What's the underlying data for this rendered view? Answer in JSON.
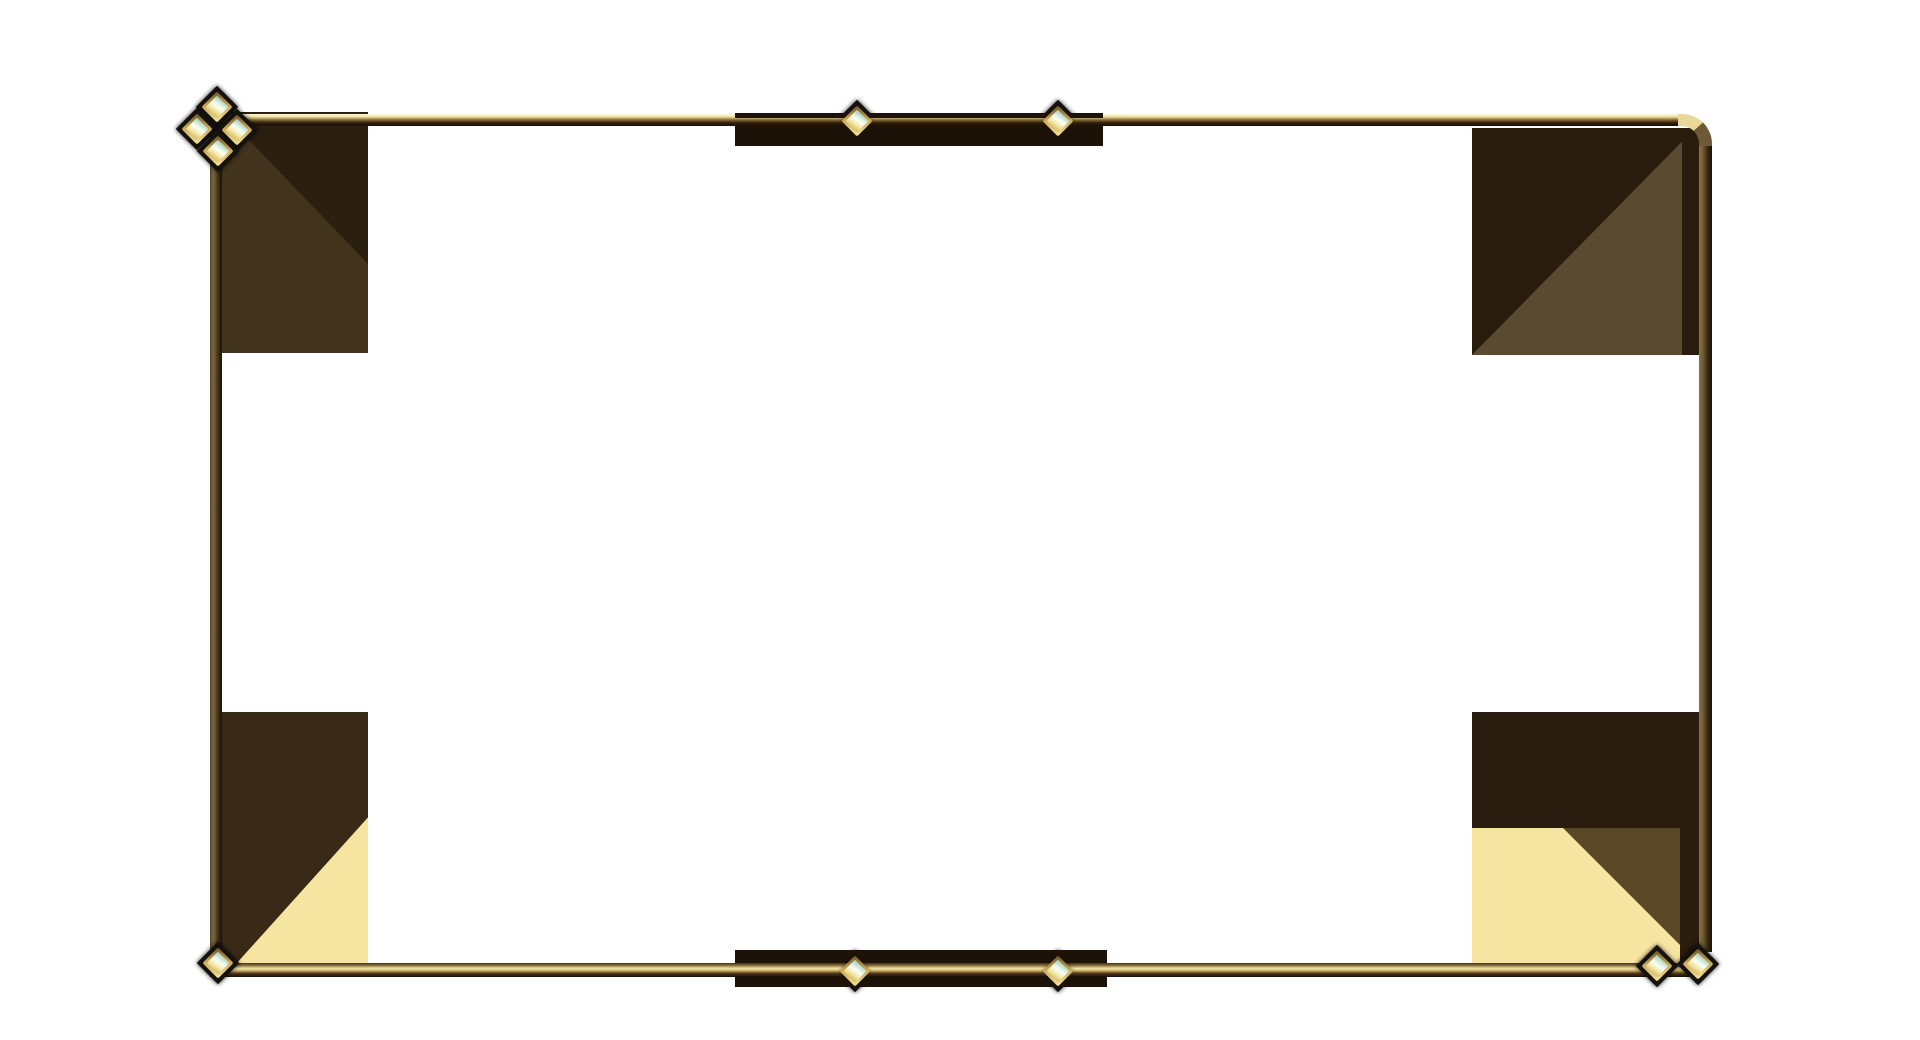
{
  "scene": {
    "description": "Ornate golden rectangular frame overlay on a white background, with dark brown corner blocks shaded by diagonal triangles, cream accents in the lower corners, dark accent bars on the top and bottom edges, and jeweled diamond gems: a four-gem cluster at the top-left corner, two gems on the top edge, two gems on the bottom edge, one gem at the bottom-left corner and a pair of gems at the bottom-right corner. The top-right corner of the frame is rounded.",
    "visible_text": ""
  },
  "colors": {
    "background": "#ffffff",
    "line-pale": "#fdf8da",
    "line-bright": "#f3e5ab",
    "line-gold": "#b89a58",
    "line-dark": "#1a1005",
    "bar": "#1c1208",
    "pad": "#151210",
    "block-tl": "#42331c",
    "block-tl-dark": "#2b1f10",
    "block-tr-dark": "#2a1c0c",
    "block-tr-light": "#594b30",
    "block-bl": "#392a17",
    "cream": "#f6e5a1",
    "block-br-dark": "#2a1c0e",
    "block-br-brown": "#594728",
    "gem-rim": "#c9a855",
    "gem-aqua": "#dff2e6",
    "gem-yellow": "#f3eaae"
  },
  "gems": [
    {
      "name": "corner-cluster-gem-top",
      "x": 217,
      "y": 107,
      "pad": "front"
    },
    {
      "name": "corner-cluster-gem-left",
      "x": 197,
      "y": 129,
      "pad": "front"
    },
    {
      "name": "corner-cluster-gem-right",
      "x": 237,
      "y": 130,
      "pad": "front"
    },
    {
      "name": "corner-cluster-gem-bottom",
      "x": 218,
      "y": 151,
      "pad": "front"
    },
    {
      "name": "top-edge-gem-left",
      "x": 857,
      "y": 121,
      "pad": "back"
    },
    {
      "name": "top-edge-gem-right",
      "x": 1058,
      "y": 121,
      "pad": "back"
    },
    {
      "name": "bottom-edge-gem-left",
      "x": 855,
      "y": 971,
      "pad": "back"
    },
    {
      "name": "bottom-edge-gem-right",
      "x": 1058,
      "y": 971,
      "pad": "back"
    },
    {
      "name": "bottom-left-corner-gem",
      "x": 218,
      "y": 963,
      "pad": "front"
    },
    {
      "name": "bottom-right-corner-gem-left",
      "x": 1657,
      "y": 966,
      "pad": "front"
    },
    {
      "name": "bottom-right-corner-gem-right",
      "x": 1698,
      "y": 964,
      "pad": "front"
    }
  ]
}
